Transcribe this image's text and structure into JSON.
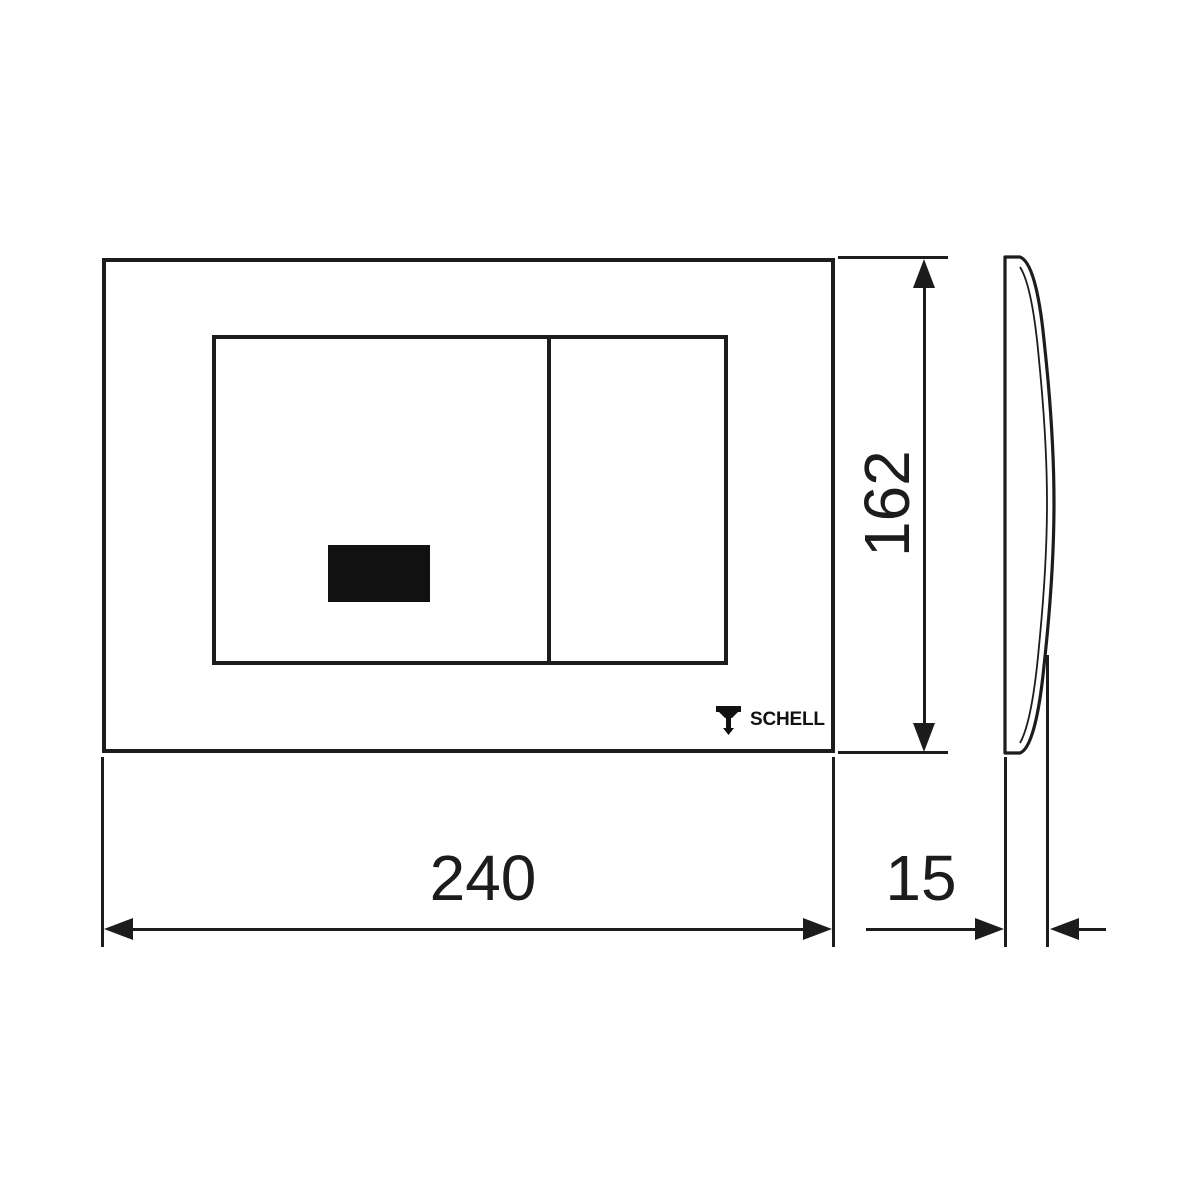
{
  "drawing": {
    "colors": {
      "background": "#ffffff",
      "line": "#1c1c1c",
      "sensor_fill": "#111111"
    },
    "front_view": {
      "logo_text": "SCHELL",
      "logo_icon": "schell-funnel-icon",
      "sensor": "ir-sensor-window"
    },
    "dimensions": {
      "width": "240",
      "height": "162",
      "depth": "15"
    }
  }
}
